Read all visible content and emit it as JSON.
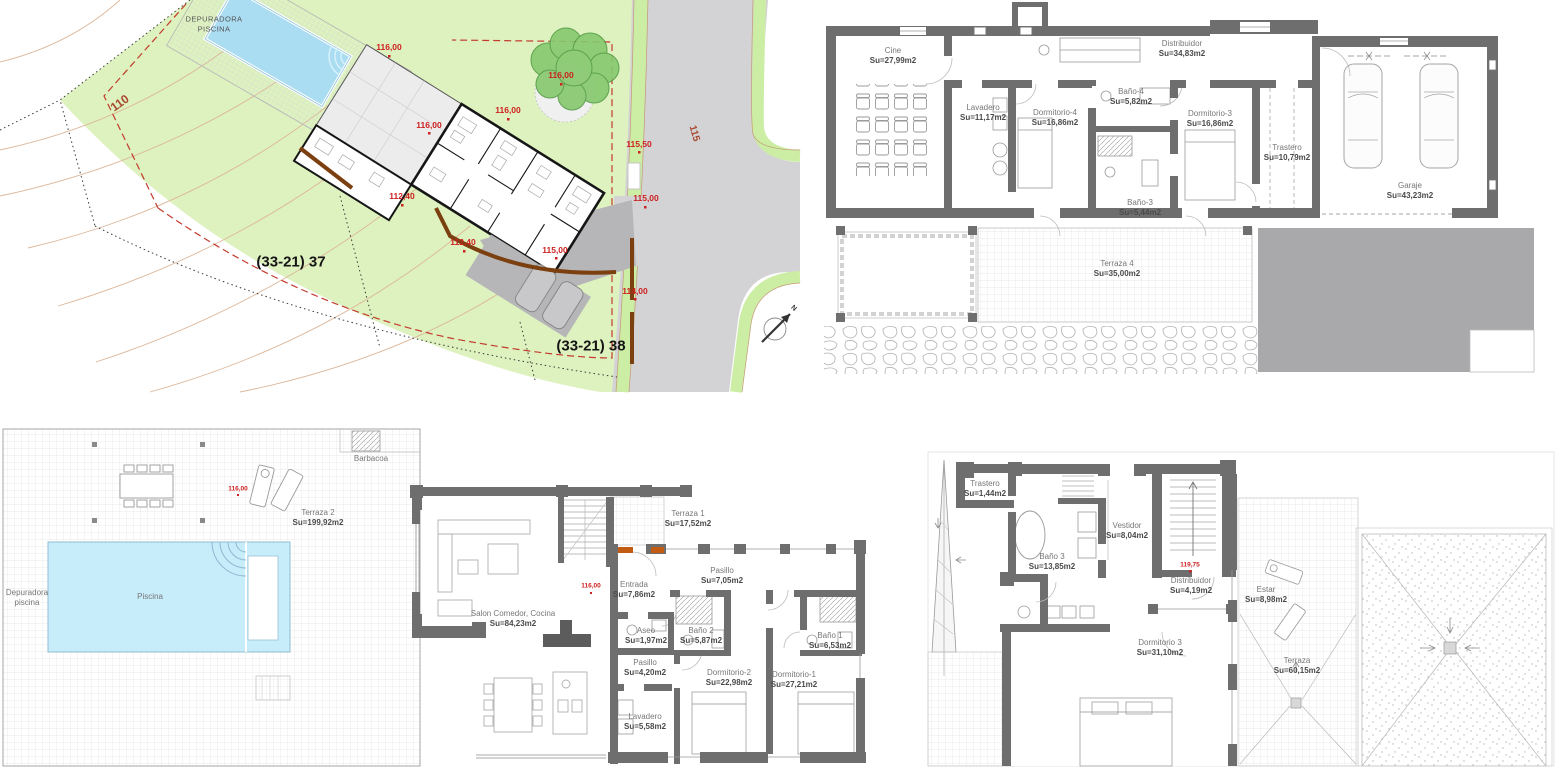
{
  "palette": {
    "wall_gray": "#6e6e6e",
    "parcel_green": "#def2bf",
    "verge_green": "#cbeda4",
    "road_gray": "#d3d3d5",
    "pool_blue": "#c7ecfa",
    "elevation_red": "#cd2020",
    "retaining_brown": "#7b3f10",
    "door_orange": "#c25c12"
  },
  "site_plan": {
    "depuradora": "DEPURADORA\nPISCINA",
    "contour_110": "110",
    "contour_115": "115",
    "parcel_37": "(33-21) 37",
    "parcel_38": "(33-21) 38",
    "north": "N",
    "elev_116": "116,00",
    "elev_115_50": "115,50",
    "elev_115": "115,00",
    "elev_112_40": "112,40",
    "elev_114": "114,00"
  },
  "basement": {
    "cine": {
      "name": "Cine",
      "area": "Su=27,99m2"
    },
    "lavadero": {
      "name": "Lavadero",
      "area": "Su=11,17m2"
    },
    "dormitorio4": {
      "name": "Dormitorio-4",
      "area": "Su=16,86m2"
    },
    "bano4": {
      "name": "Baño-4",
      "area": "Su=5,82m2"
    },
    "bano3": {
      "name": "Baño-3",
      "area": "Su=5,44m2"
    },
    "dormitorio3": {
      "name": "Dormitorio-3",
      "area": "Su=16,86m2"
    },
    "distribuidor": {
      "name": "Distribuidor",
      "area": "Su=34,83m2"
    },
    "trastero": {
      "name": "Trastero",
      "area": "Su=10,79m2"
    },
    "garaje": {
      "name": "Garaje",
      "area": "Su=43,23m2"
    },
    "terraza4": {
      "name": "Terraza 4",
      "area": "Su=35,00m2"
    }
  },
  "ground": {
    "terraza2": {
      "name": "Terraza 2",
      "area": "Su=199,92m2"
    },
    "piscina": {
      "name": "Piscina"
    },
    "depuradora": {
      "name": "Depuradora\npiscina"
    },
    "barbacoa": {
      "name": "Barbacoa"
    },
    "elev": "116,00",
    "salon": {
      "name": "Salon Comedor, Cocina",
      "area": "Su=84,23m2"
    },
    "terraza1": {
      "name": "Terraza 1",
      "area": "Su=17,52m2"
    },
    "pasillo1": {
      "name": "Pasillo",
      "area": "Su=7,05m2"
    },
    "entrada": {
      "name": "Entrada",
      "area": "Su=7,86m2"
    },
    "aseo": {
      "name": "Aseo",
      "area": "Su=1,97m2"
    },
    "bano2": {
      "name": "Baño 2",
      "area": "Su=5,87m2"
    },
    "bano1": {
      "name": "Baño 1",
      "area": "Su=6,53m2"
    },
    "pasillo2": {
      "name": "Pasillo",
      "area": "Su=4,20m2"
    },
    "dormitorio2": {
      "name": "Dormitorio-2",
      "area": "Su=22,98m2"
    },
    "dormitorio1": {
      "name": "Dormitorio-1",
      "area": "Su=27,21m2"
    },
    "lavadero": {
      "name": "Lavadero",
      "area": "Su=5,58m2"
    }
  },
  "top_floor": {
    "trastero": {
      "name": "Trastero",
      "area": "Su=1,44m2"
    },
    "bano3": {
      "name": "Baño 3",
      "area": "Su=13,85m2"
    },
    "vestidor": {
      "name": "Vestidor",
      "area": "Su=8,04m2"
    },
    "distribuidor": {
      "name": "Distribuidor",
      "area": "Su=4,19m2"
    },
    "elev": "119,75",
    "estar": {
      "name": "Estar",
      "area": "Su=8,98m2"
    },
    "dormitorio3": {
      "name": "Dormitorio 3",
      "area": "Su=31,10m2"
    },
    "terraza": {
      "name": "Terraza",
      "area": "Su=60,15m2"
    }
  }
}
